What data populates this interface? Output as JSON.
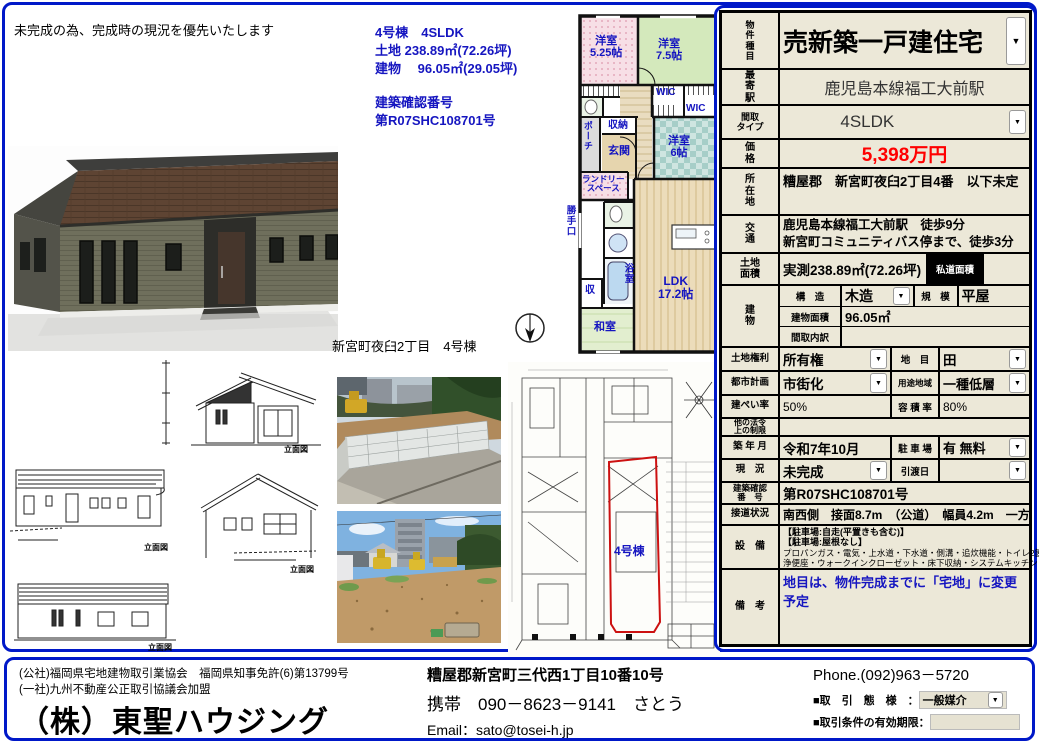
{
  "colors": {
    "accent_blue": "#0018c8",
    "text_blue": "#1515c0",
    "price_red": "#ff0000",
    "table_beige": "#ece8d8",
    "siteplan_red": "#cc1111"
  },
  "icons": {
    "dropdown": "▼"
  },
  "header": {
    "disclaimer": "未完成の為、完成時の現況を優先いたします"
  },
  "summary": {
    "line1": "4号棟　4SLDK",
    "line2": "土地 238.89㎡(72.26坪)",
    "line3": "建物　 96.05㎡(29.05坪)",
    "line4": "建築確認番号",
    "line5": "第R07SHC108701号"
  },
  "caption": "新宮町夜臼2丁目　4号棟",
  "floorplan": {
    "room1": "洋室\n5.25帖",
    "room2": "洋室\n7.5帖",
    "wic1": "WIC",
    "wic2": "WIC",
    "storage": "収納",
    "entrance": "玄関",
    "porch": "ポーチ",
    "laundry": "ランドリー\nスペース",
    "kitchen_door": "勝手口",
    "bath": "浴室",
    "closet": "収",
    "washitsu": "和室",
    "room3": "洋室\n6帖",
    "ldk": "LDK\n17.2帖"
  },
  "siteplan": {
    "unit_label": "4号棟"
  },
  "elevations": {
    "label1": "立面図",
    "label2": "立面図",
    "label3": "立面図",
    "label4": "立面図"
  },
  "table": {
    "property_type": {
      "label": "物\n件\n種\n目",
      "value": "売新築一戸建住宅"
    },
    "station": {
      "label": "最\n寄\n駅",
      "value": "鹿児島本線福工大前駅"
    },
    "layout": {
      "label": "間取\nタイプ",
      "value": "4SLDK"
    },
    "price": {
      "label": "価\n格",
      "value": "5,398万円"
    },
    "location": {
      "label": "所\n在\n地",
      "value": "糟屋郡　新宮町夜臼2丁目4番　以下未定"
    },
    "access": {
      "label": "交\n通",
      "value": "鹿児島本線福工大前駅　徒歩9分\n新宮町コミュニティバス停まで、徒歩3分"
    },
    "land": {
      "label": "土地\n面積",
      "value": "実測238.89㎡(72.26坪)",
      "private_road": "私道面積"
    },
    "building": {
      "label": "建\n物",
      "structure_label": "構　造",
      "structure": "木造",
      "scale_label": "規　模",
      "scale": "平屋",
      "area_label": "建物面積",
      "area": "96.05㎡",
      "layout_label": "間取内訳",
      "layout_value": ""
    },
    "rights": {
      "label": "土地権利",
      "value": "所有権",
      "lot_label": "地　目",
      "lot": "田"
    },
    "city": {
      "label": "都市計画",
      "value": "市街化",
      "zone_label": "用途地域",
      "zone": "一種低層"
    },
    "coverage": {
      "label": "建ぺい率",
      "value": "50%",
      "far_label": "容 積 率",
      "far": "80%"
    },
    "other_law": {
      "label": "他の法令\n上の制限",
      "value": ""
    },
    "built": {
      "label": "築 年 月",
      "value": "令和7年10月",
      "parking_label": "駐 車 場",
      "parking": "有 無料"
    },
    "status": {
      "label": "現　況",
      "value": "未完成",
      "handover_label": "引渡日",
      "handover": ""
    },
    "confirm": {
      "label": "建築確認\n番　号",
      "value": "第R07SHC108701号"
    },
    "road": {
      "label": "接道状況",
      "value": "南西側　接面8.7m　（公道）　幅員4.2m　一方"
    },
    "equipment": {
      "label": "設　備",
      "line1": "【駐車場:自走(平置きも含む)】",
      "line2": "【駐車場:屋根なし】",
      "line3": "プロパンガス・電気・上水道・下水道・側溝・追炊機能・トイレ2箇所・温水洗",
      "line4": "浄便座・ウォークインクローゼット・床下収納・システムキッチン・カウン"
    },
    "remarks": {
      "label": "備　考",
      "value": "地目は、物件完成までに「宅地」に変更予定"
    }
  },
  "footer": {
    "license1": "(公社)福岡県宅地建物取引業協会　福岡県知事免許(6)第13799号",
    "license2": "(一社)九州不動産公正取引協議会加盟",
    "company": "（株）東聖ハウジング",
    "address": "糟屋郡新宮町三代西1丁目10番10号",
    "mobile": "携帯　090－8623－9141　さとう",
    "email": "Email：sato@tosei-h.jp",
    "phone": "Phone.(092)963－5720",
    "deal_label": "■取　引　態　様　：",
    "deal_value": "一般媒介",
    "validity_label": "■取引条件の有効期限："
  }
}
